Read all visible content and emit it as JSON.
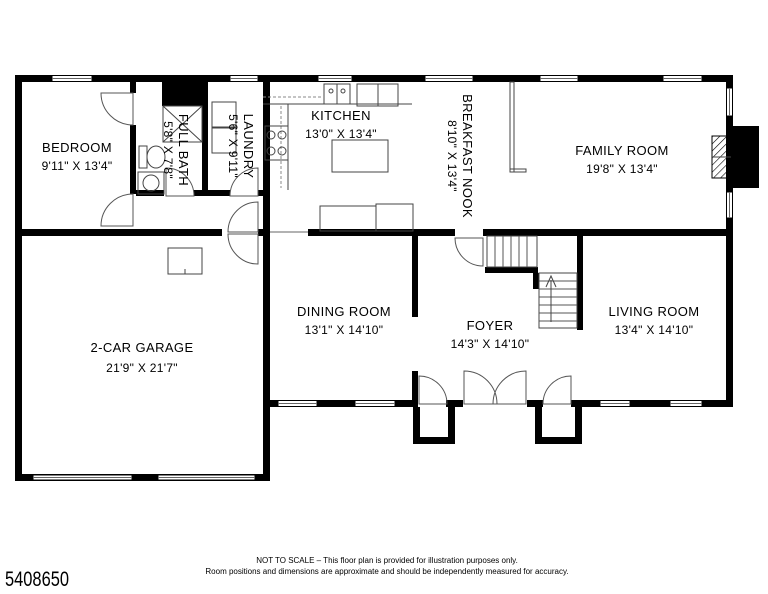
{
  "footer": {
    "plan_id": "5408650",
    "disclaimer_line1": "NOT TO SCALE – This floor plan is provided for illustration purposes only.",
    "disclaimer_line2": "Room positions and dimensions are approximate and should be independently measured for accuracy."
  },
  "rooms": {
    "bedroom": {
      "name": "BEDROOM",
      "dims": "9'11\" X 13'4\""
    },
    "full_bath": {
      "name": "FULL BATH",
      "dims": "5'8\" X 7'8\""
    },
    "laundry": {
      "name": "LAUNDRY",
      "dims": "5'6\" X 9'11\""
    },
    "kitchen": {
      "name": "KITCHEN",
      "dims": "13'0\" X 13'4\""
    },
    "breakfast_nook": {
      "name": "BREAKFAST NOOK",
      "dims": "8'10\" X 13'4\""
    },
    "family_room": {
      "name": "FAMILY ROOM",
      "dims": "19'8\" X 13'4\""
    },
    "garage": {
      "name": "2-CAR GARAGE",
      "dims": "21'9\" X 21'7\""
    },
    "dining_room": {
      "name": "DINING ROOM",
      "dims": "13'1\" X 14'10\""
    },
    "foyer": {
      "name": "FOYER",
      "dims": "14'3\" X 14'10\""
    },
    "living_room": {
      "name": "LIVING ROOM",
      "dims": "13'4\" X 14'10\""
    }
  },
  "colors": {
    "line": "#000000",
    "background": "#ffffff"
  }
}
